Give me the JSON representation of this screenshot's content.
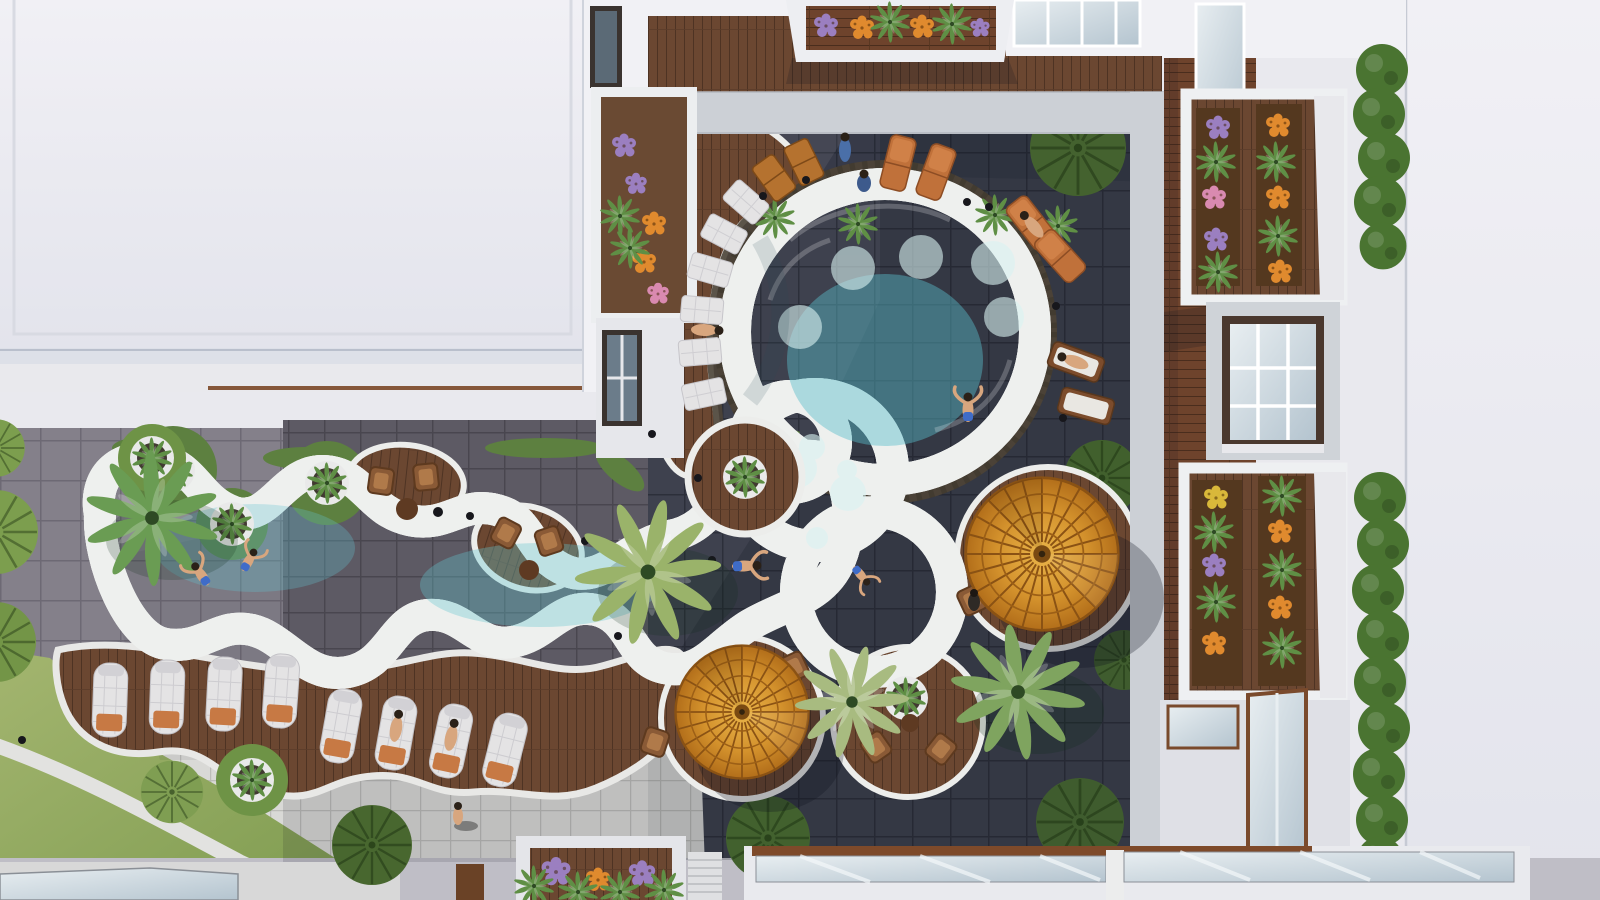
{
  "scene": {
    "title": "Aerial top-down view of a resort courtyard with freeform lagoon pool",
    "description": "Bird's-eye 3D rendering: a circular main pool joined to a wavy lagoon, wrapped by wooden decks, white scalloped rims, dark slate courtyard tiles, amber parasols, palm trees, flower-box balconies and white rooftops.",
    "inventory": {
      "pools": 2,
      "amber_umbrellas": 2,
      "palm_trees": 4,
      "white_sun_loungers": 8,
      "orange_pool_loungers": 6,
      "deck_seat_pads": 8,
      "wooden_chairs": 6,
      "round_planters": 7,
      "grass_circles": 8,
      "flower_balconies": 4,
      "hedge_bushes": 13,
      "people": 15
    }
  },
  "colors": {
    "roof": "#ebeaf1",
    "roofFar": "#e7e8ee",
    "facade": "#f1f1f5",
    "walk": "#ccd0d6",
    "paver": "#d9d9d6",
    "tileDark": "#3e414e",
    "tileMid": "#5d5a64",
    "tileGray": "#84808a",
    "wood1": "#6b4731",
    "wood2": "#5e3d29",
    "board": "#6e432c",
    "mosaic": "#4b4237",
    "rim": "#eef0ee",
    "waterHi": "#aee9ec",
    "waterMid": "#7ed6dd",
    "waterLo": "#5fc3cf",
    "lawnHi": "#a3b56f",
    "lawnLo": "#7f9c50",
    "grassDark": "#44622f",
    "grassMid": "#5d8040",
    "grassLight": "#7fa050",
    "hedge": "#4a7431",
    "umbHi": "#eab54a",
    "umbLo": "#c07b1e",
    "towel": "#c77944",
    "loungerCream": "#e4e3e4",
    "loungerOrange": "#c0713a",
    "flowerOrange": "#e08a2e",
    "flowerPurple": "#9b7fc0",
    "flowerYellow": "#d9b83a",
    "flowerPink": "#d98ab0",
    "skin": "#d8a67e",
    "glassHi": "#e8eef1",
    "glassLo": "#b4c4cf",
    "shadow": "#0e1220"
  }
}
